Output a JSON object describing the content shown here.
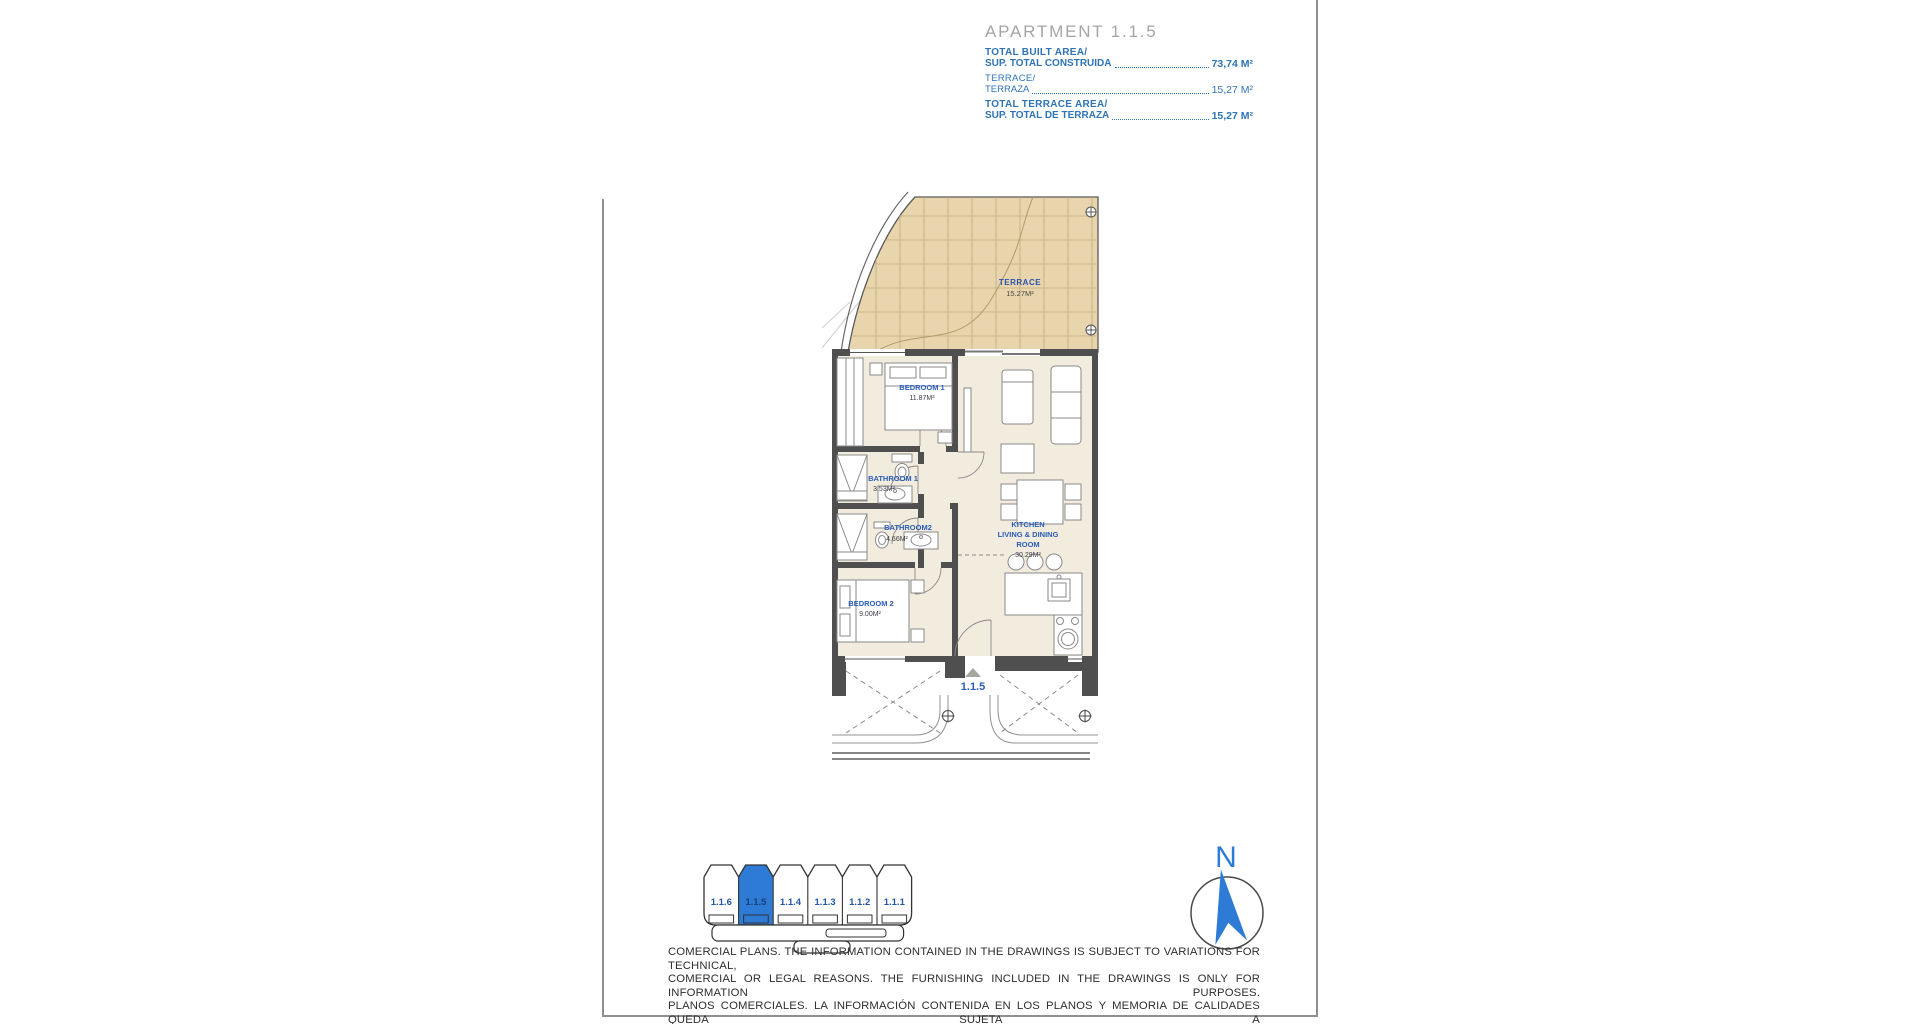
{
  "header": {
    "title": "APARTMENT 1.1.5",
    "rows": [
      {
        "line1": "TOTAL BUILT AREA/",
        "line2": "SUP. TOTAL CONSTRUIDA",
        "value": "73,74 M²"
      },
      {
        "line1": "TERRACE/",
        "line2": "TERRAZA",
        "value": "15,27 M²"
      },
      {
        "line1": "TOTAL TERRACE AREA/",
        "line2": "SUP. TOTAL DE TERRAZA",
        "value": "15,27 M²"
      }
    ]
  },
  "floor_plan": {
    "rooms": {
      "terrace": {
        "name": "TERRACE",
        "area": "15.27M²"
      },
      "bedroom1": {
        "name": "BEDROOM 1",
        "area": "11.87M²"
      },
      "bathroom1": {
        "name": "BATHROOM 1",
        "area": "3.53M²"
      },
      "bathroom2": {
        "name": "BATHROOM2",
        "area": "4.66M²"
      },
      "bedroom2": {
        "name": "BEDROOM 2",
        "area": "9.00M²"
      },
      "kitchen": {
        "name_line1": "KITCHEN",
        "name_line2": "LIVING & DINING",
        "name_line3": "ROOM",
        "area": "30.29M²"
      }
    },
    "unit_marker": "1.1.5"
  },
  "key_plan": {
    "units": [
      {
        "label": "1.1.6"
      },
      {
        "label": "1.1.5"
      },
      {
        "label": "1.1.4"
      },
      {
        "label": "1.1.3"
      },
      {
        "label": "1.1.2"
      },
      {
        "label": "1.1.1"
      }
    ],
    "highlighted_unit": "1.1.5"
  },
  "compass": {
    "label": "N"
  },
  "disclaimer": {
    "lines": [
      "COMERCIAL PLANS. THE INFORMATION CONTAINED IN THE DRAWINGS IS SUBJECT TO VARIATIONS FOR TECHNICAL,",
      "COMERCIAL OR LEGAL REASONS. THE FURNISHING INCLUDED IN THE DRAWINGS IS ONLY FOR INFORMATION PURPOSES.",
      "PLANOS COMERCIALES. LA INFORMACIÓN CONTENIDA EN LOS PLANOS Y MEMORIA DE CALIDADES QUEDA SUJETA A",
      "VARIACIONES POR MOTIVOS TÉCNICOS, COMERCIALES O LEGALES. EL AMUEBLAMIENTO QUE APARECE EN LOS PLANOS",
      "ES MERAMENTE INFORMATIVO."
    ]
  },
  "colors": {
    "blue_text": "#2f74b5",
    "title_gray": "#a5a5a5",
    "room_label_blue": "#2a5cb8",
    "area_text_dark": "#3c3c46",
    "terrace_fill": "#e8d5ad",
    "floor_fill": "#f2ecdf",
    "wall": "#4f4f4f",
    "key_highlight": "#2e7bd6",
    "key_label": "#2456a8",
    "compass_blue": "#2e7bd6"
  }
}
